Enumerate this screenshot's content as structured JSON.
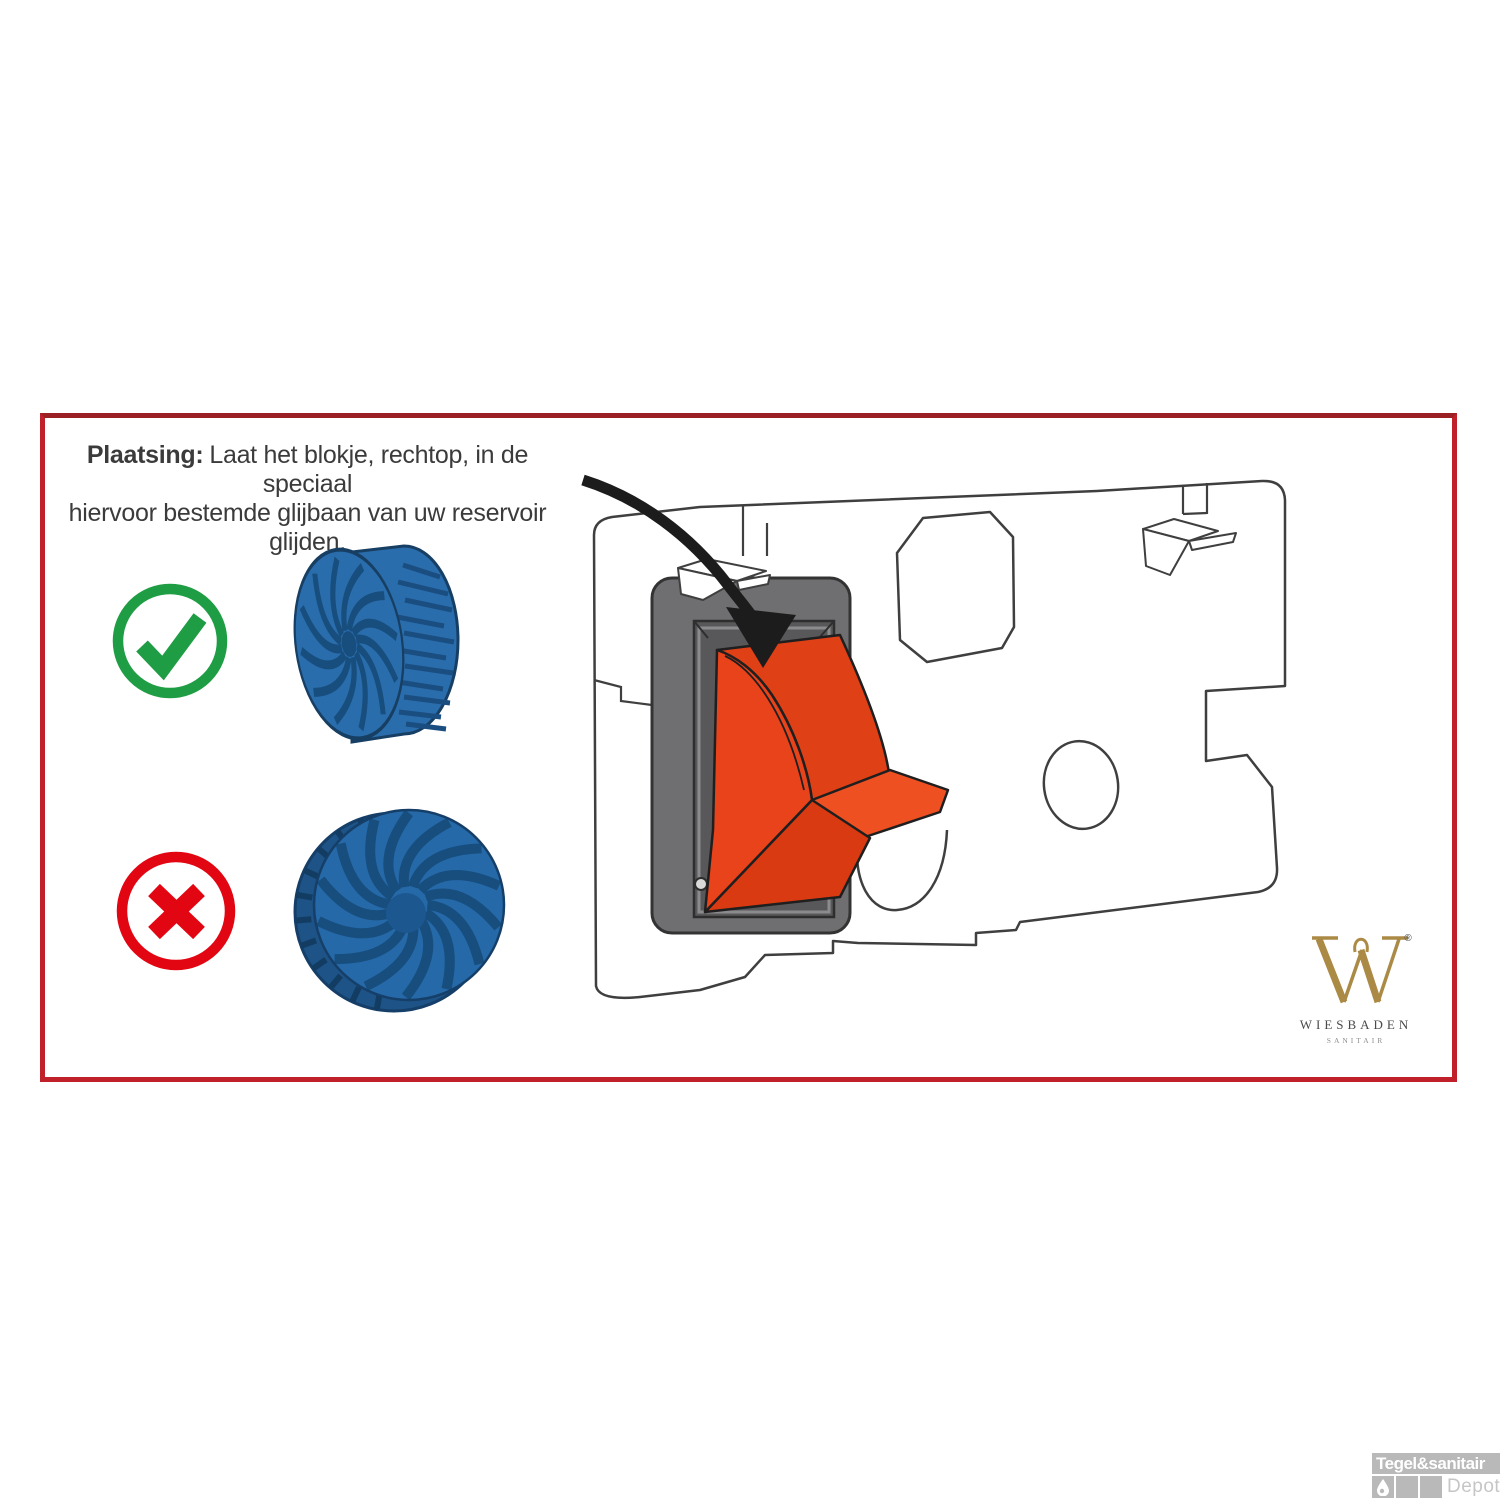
{
  "panel": {
    "border_color": "#c0202a"
  },
  "instruction": {
    "label": "Plaatsing:",
    "line1": "Laat het blokje, rechtop, in de speciaal",
    "line2": "hiervoor bestemde glijbaan van uw reservoir glijden.",
    "text_color": "#3b3b3b"
  },
  "guidance": {
    "correct": {
      "icon": "check-circle-icon",
      "color": "#1f9d44",
      "tablet_orientation": "upright"
    },
    "incorrect": {
      "icon": "cross-circle-icon",
      "color": "#e20613",
      "tablet_orientation": "flat"
    },
    "tablet": {
      "base_color": "#2a6dad",
      "face_color": "#2569a9",
      "swirl_color": "#174e7e",
      "rim_color": "#1d5386"
    }
  },
  "diagram": {
    "subject": "cistern-access-plate-with-insert-funnel",
    "funnel_color": "#e8431b",
    "funnel_shade": "#da3a12",
    "funnel_lip": "#ef5022",
    "frame_color": "#6f6f71",
    "recess_color": "#58585a",
    "outline_color": "#3f3f3f",
    "arrow_color": "#1c1c1c",
    "arrow_icon": "insert-arrow-icon"
  },
  "brand": {
    "monogram": "W",
    "registered_mark": "®",
    "name": "WIESBADEN",
    "subtitle": "SANITAIR",
    "gold_color": "#ab8a45",
    "name_color": "#4a4a4a",
    "subtitle_color": "#8f8f8f"
  },
  "watermark": {
    "title": "Tegel&sanitair",
    "subtitle": "Depot",
    "color": "#b9b9b9",
    "icon": "droplet-icon"
  }
}
